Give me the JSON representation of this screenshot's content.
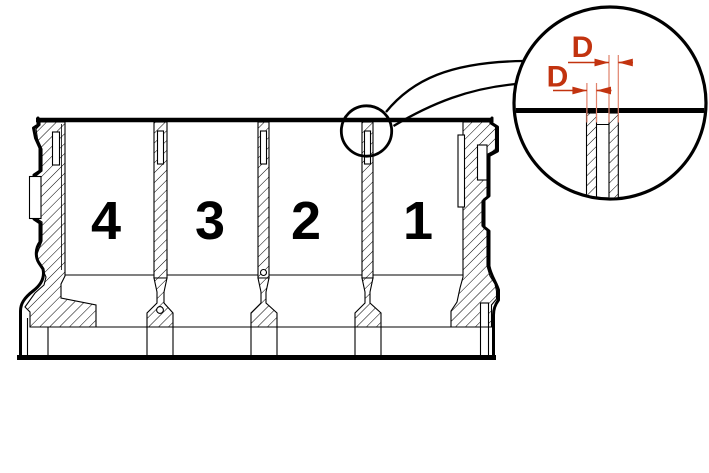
{
  "diagram": {
    "cylinders": [
      {
        "label": "4"
      },
      {
        "label": "3"
      },
      {
        "label": "2"
      },
      {
        "label": "1"
      }
    ],
    "detail_view": {
      "dimensions": [
        {
          "label": "D"
        },
        {
          "label": "D"
        }
      ]
    },
    "colors": {
      "line": "#000000",
      "dimension_accent": "#c2330f",
      "dimension_extension": "#e0826c",
      "background": "#ffffff"
    },
    "icons": [
      {
        "name": "callout-circle-icon"
      },
      {
        "name": "detail-magnifier-circle-icon"
      }
    ]
  }
}
